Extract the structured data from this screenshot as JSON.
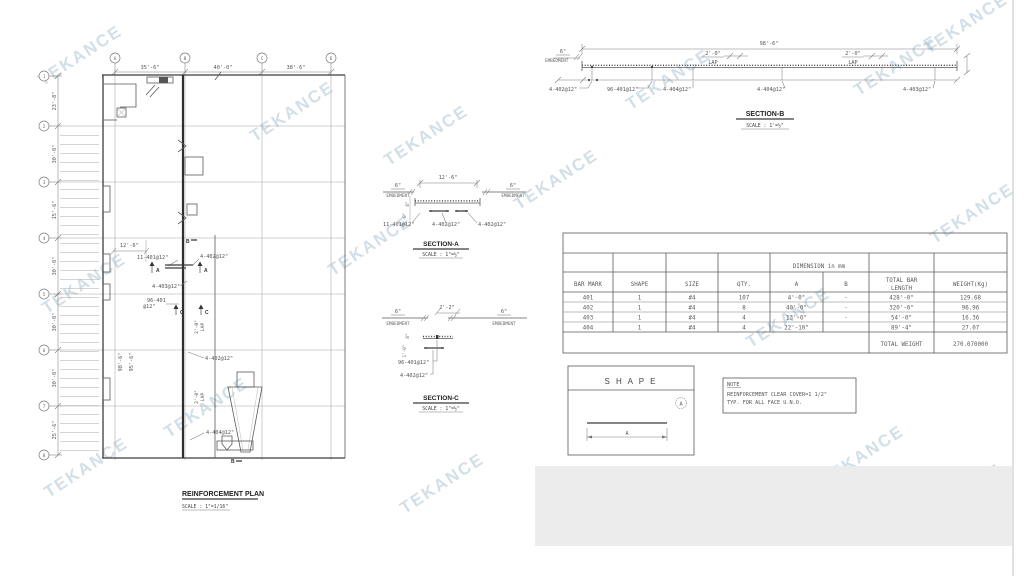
{
  "watermark": {
    "text": "TEKANCE",
    "color": "#94b2c6"
  },
  "plan": {
    "title": "REINFORCEMENT PLAN",
    "scale": "SCALE : 1\"=1/16\"",
    "grid_cols": [
      {
        "label": "A",
        "dim_after": "35'-6\""
      },
      {
        "label": "B",
        "dim_after": "40'-0\""
      },
      {
        "label": "C",
        "dim_after": "38'-6\""
      },
      {
        "label": "D",
        "dim_after": ""
      }
    ],
    "grid_rows": [
      {
        "label": "1",
        "dim_after": "23'-8\""
      },
      {
        "label": "2",
        "dim_after": "30'-0\""
      },
      {
        "label": "3",
        "dim_after": "15'-6\""
      },
      {
        "label": "4",
        "dim_after": "30'-0\""
      },
      {
        "label": "5",
        "dim_after": "30'-0\""
      },
      {
        "label": "6",
        "dim_after": "30'-0\""
      },
      {
        "label": "7",
        "dim_after": "25'-6\""
      },
      {
        "label": "8",
        "dim_after": ""
      }
    ],
    "ann": {
      "dim_strip": "12'-6\"",
      "bars_401_top": "11-401@12\"",
      "bars_402_top": "4-402@12\"",
      "bars_403": "4-403@12\"",
      "bars_401_main_l1": "96-401",
      "bars_401_main_l2": "@12\"",
      "bars_402_mid": "4-402@12\"",
      "bars_404": "4-404@12\"",
      "dim_v1": "98'-6\"",
      "dim_v2": "95'-6\"",
      "lap_dim": "2'-0\"",
      "lap_word": "LAP",
      "marker_a": "A",
      "marker_b": "B",
      "marker_c": "C"
    }
  },
  "section_a": {
    "title": "SECTION-A",
    "scale": "SCALE : 1\"=½\"",
    "dim_top": "12'-6\"",
    "embed_dim": "6\"",
    "embed_word": "EMBEDMENT",
    "side_dim1": "8\"",
    "side_dim2": "1'-0\"",
    "labels": [
      "11-401@12\"",
      "4-402@12\"",
      "4-402@12\""
    ]
  },
  "section_c": {
    "title": "SECTION-C",
    "scale": "SCALE : 1\"=½\"",
    "dim_top": "2'-2\"",
    "embed_dim": "6\"",
    "embed_word": "EMBEDMENT",
    "side_dim1": "8\"",
    "side_dim2": "1'-0\"",
    "labels": [
      "96-401@12\"",
      "4-402@12\""
    ]
  },
  "section_b": {
    "title": "SECTION-B",
    "scale": "SCALE : 1'=½\"",
    "dim_top": "98'-6\"",
    "embed_dim": "6\"",
    "embed_word": "EMBEDMENT",
    "lap_dim": "2'-0\"",
    "lap_word": "LAP",
    "labels": [
      "4-402@12\"",
      "96-401@12\"",
      "4-404@12\"",
      "4-404@12\"",
      "4-403@12\""
    ]
  },
  "table": {
    "dim_header": "DIMENSION in mm",
    "columns": [
      "BAR MARK",
      "SHAPE",
      "SIZE",
      "QTY.",
      "A",
      "B",
      [
        "TOTAL BAR",
        "LENGTH"
      ],
      "WEIGHT(Kg)"
    ],
    "rows": [
      [
        "401",
        "1",
        "#4",
        "107",
        "4'-0\"",
        "-",
        "428'-0\"",
        "129.68"
      ],
      [
        "402",
        "1",
        "#4",
        "8",
        "40'-0\"",
        "-",
        "320'-0\"",
        "96.96"
      ],
      [
        "403",
        "1",
        "#4",
        "4",
        "13'-6\"",
        "-",
        "54'-0\"",
        "16.36"
      ],
      [
        "404",
        "1",
        "#4",
        "4",
        "22'-10\"",
        "",
        "89'-4\"",
        "27.07"
      ]
    ],
    "total_label": "TOTAL WEIGHT",
    "total_value": "270.070000"
  },
  "shape_box": {
    "title": "S H A P E",
    "mark": "A",
    "dim_label": "A"
  },
  "note_box": {
    "title": "NOTE",
    "line1": "REINFORCEMENT CLEAR COVER=1 1/2\"",
    "line2": "TYP. FOR ALL FACE U.N.O."
  }
}
